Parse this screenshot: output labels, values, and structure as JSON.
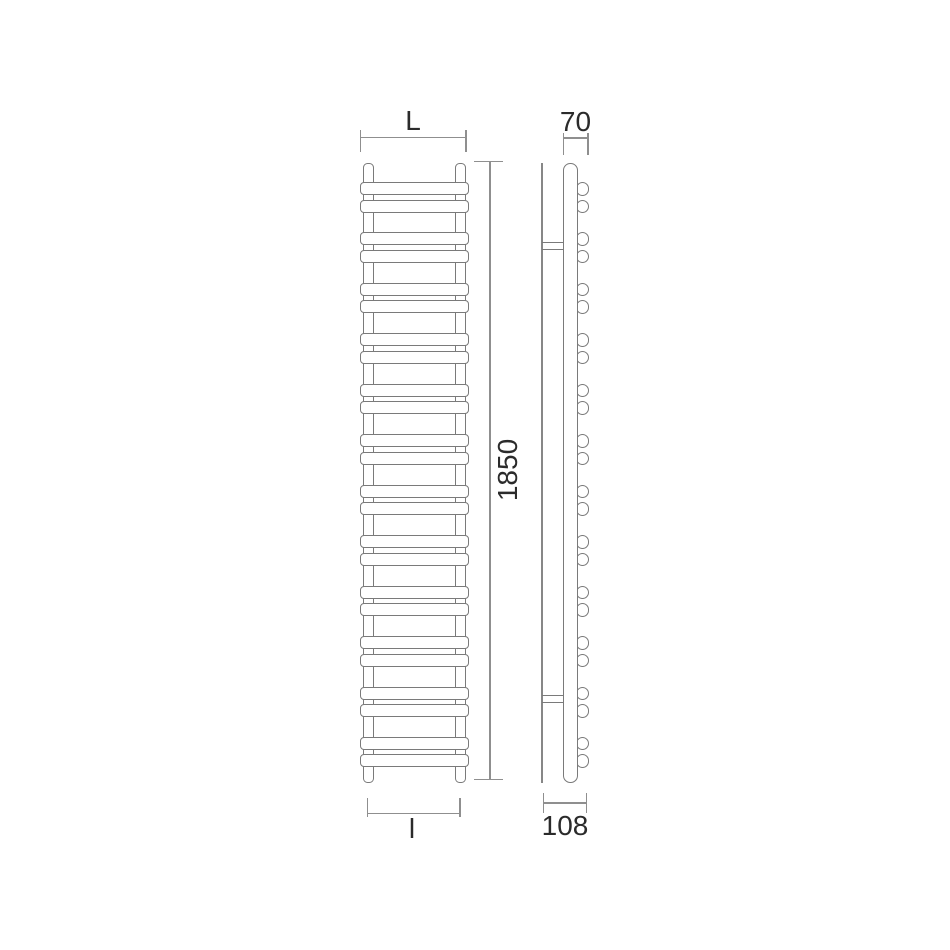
{
  "title": "towel-radiator-technical-drawing",
  "front_view": {
    "bar_pairs": 12,
    "bars_total": 24,
    "rails": 2
  },
  "side_view": {
    "bar_end_pairs": 12,
    "wall_brackets": 2
  },
  "dimensions": {
    "overall_width_label": "L",
    "overall_height_label": "1850",
    "bottom_width_label": "l",
    "depth_top_label": "70",
    "depth_bottom_label": "108"
  },
  "colors": {
    "outline": "#7a7a7a",
    "dimension_line": "#8f8f8f",
    "label_text": "#2b2b2b",
    "background": "#ffffff"
  }
}
